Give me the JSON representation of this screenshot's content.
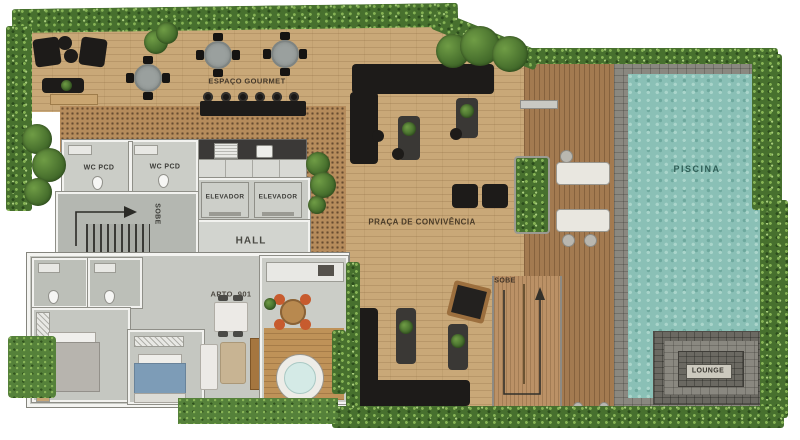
{
  "plan": {
    "type": "residential-leisure-floor-plan",
    "areas": {
      "espaco_gourmet": "ESPAÇO GOURMET",
      "wc_pcd_left": "WC PCD",
      "wc_pcd_right": "WC PCD",
      "stairs_internal": "SOBE",
      "elevator_left": "ELEVADOR",
      "elevator_right": "ELEVADOR",
      "hall": "HALL",
      "apartment": "APTO. 901",
      "praca": "PRAÇA DE CONVIVÊNCIA",
      "stairs_deck": "SOBE",
      "pool": "PISCINA",
      "lounge": "LOUNGE"
    },
    "colors": {
      "hedge_green": "#47702e",
      "deck_light_wood": "#c9a878",
      "deck_dark_wood": "#a37a50",
      "pool_water_teal": "#8ac0b6",
      "stone_gray": "#8a8880",
      "room_floor_gray": "#c9cbc5",
      "accent_black_furniture": "#1d1b19"
    }
  }
}
